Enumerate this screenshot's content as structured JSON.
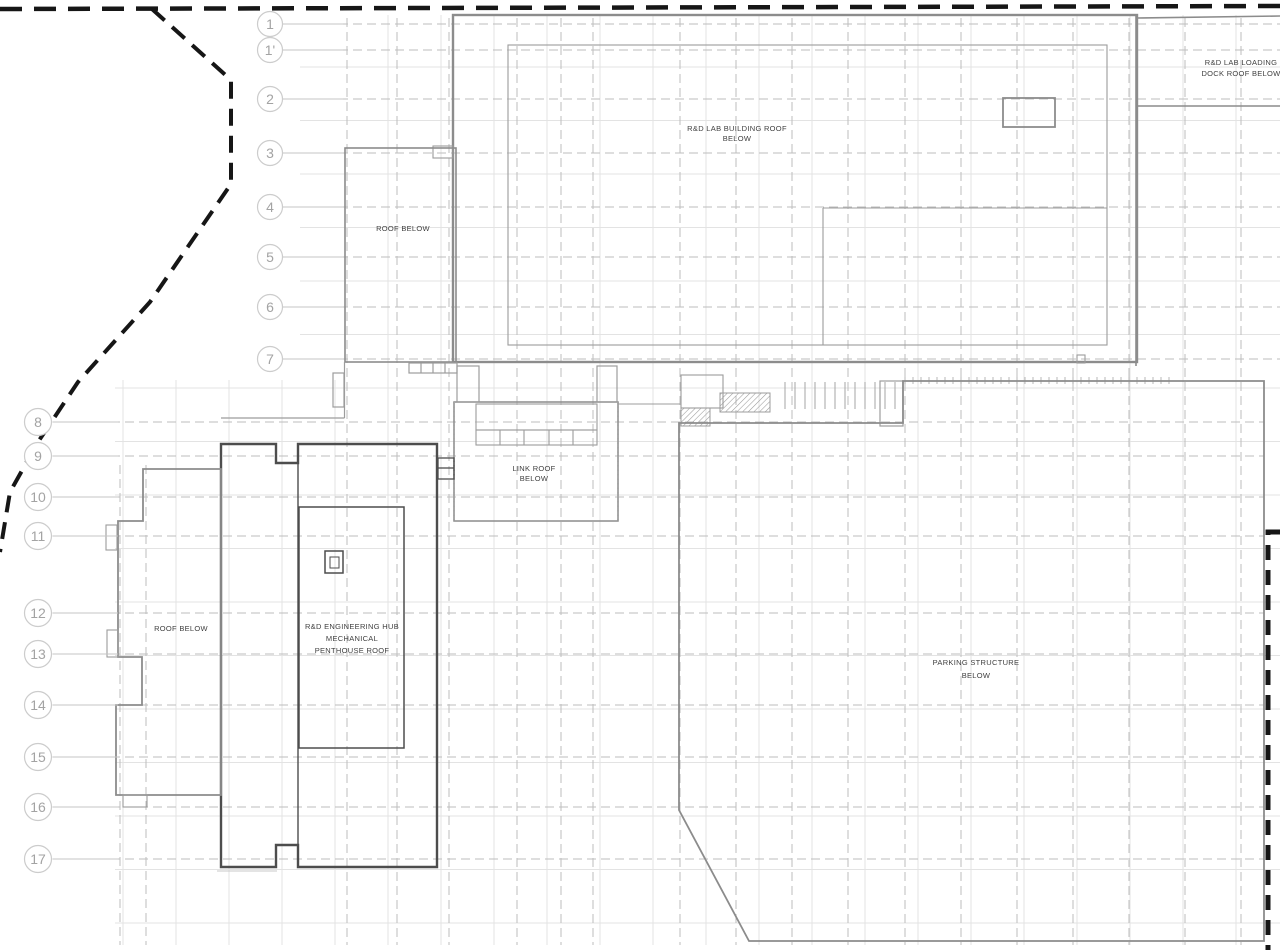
{
  "drawing": {
    "type": "architectural-roof-plan",
    "labels": {
      "lab_roof": [
        "R&D LAB BUILDING ROOF",
        "BELOW"
      ],
      "loading_dock": [
        "R&D LAB LOADING",
        "DOCK ROOF BELOW"
      ],
      "roof_below_upper": "ROOF BELOW",
      "link_roof": [
        "LINK ROOF",
        "BELOW"
      ],
      "roof_below_west": "ROOF BELOW",
      "penthouse": [
        "R&D ENGINEERING HUB",
        "MECHANICAL",
        "PENTHOUSE ROOF"
      ],
      "parking": [
        "PARKING STRUCTURE",
        "BELOW"
      ]
    },
    "grid": {
      "top_bubbles": [
        "1",
        "1'",
        "2",
        "3",
        "4",
        "5",
        "6",
        "7"
      ],
      "left_bubbles": [
        "8",
        "9",
        "10",
        "11",
        "12",
        "13",
        "14",
        "15",
        "16",
        "17"
      ]
    },
    "colors": {
      "background": "#ffffff",
      "property_line": "#161616",
      "building_outline": "#8c8c8c",
      "building_outline_dark": "#4d4d4d",
      "inner_line": "#9c9c9c",
      "grid_light": "#e3e3e3",
      "grid_dashed": "#bdbdbd",
      "bubble_stroke": "#cccccc",
      "bubble_text": "#a3a3a3",
      "label_text": "#3f3f3f"
    }
  }
}
